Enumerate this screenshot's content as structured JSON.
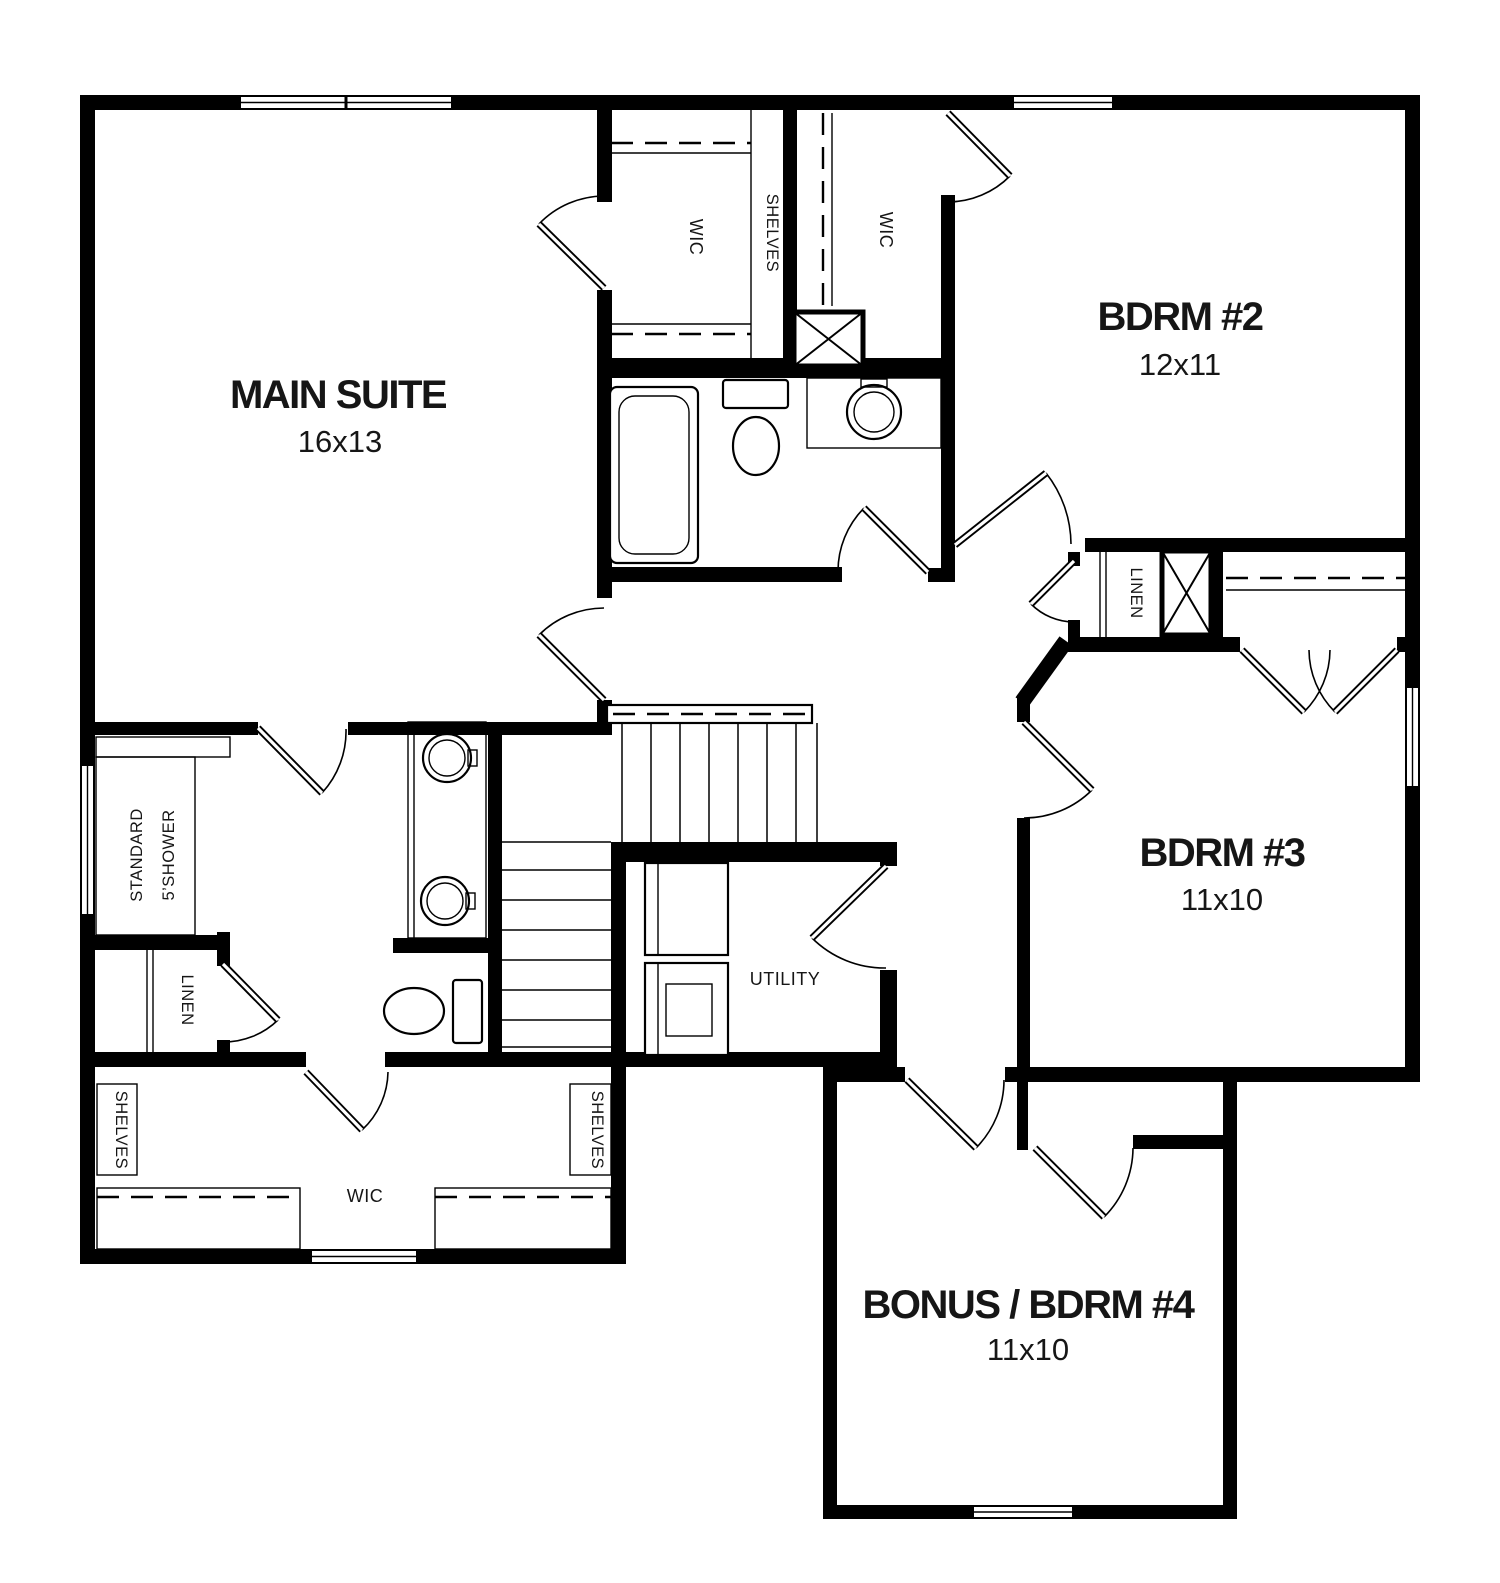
{
  "colors": {
    "wall": "#000000",
    "floor": "#ffffff",
    "text": "#161616"
  },
  "rooms": {
    "main_suite": {
      "name": "MAIN SUITE",
      "dims": "16x13"
    },
    "bdrm2": {
      "name": "BDRM #2",
      "dims": "12x11"
    },
    "bdrm3": {
      "name": "BDRM #3",
      "dims": "11x10"
    },
    "bonus": {
      "name": "BONUS / BDRM #4",
      "dims": "11x10"
    },
    "utility": {
      "name": "UTILITY"
    }
  },
  "labels": {
    "wic_upper": "WIC",
    "shelves_upper": "SHELVES",
    "wic_bdrm2": "WIC",
    "linen_hall": "LINEN",
    "shower_line1": "STANDARD",
    "shower_line2": "5’SHOWER",
    "linen_bath": "LINEN",
    "shelves_left": "SHELVES",
    "shelves_right": "SHELVES",
    "wic_lower": "WIC"
  }
}
